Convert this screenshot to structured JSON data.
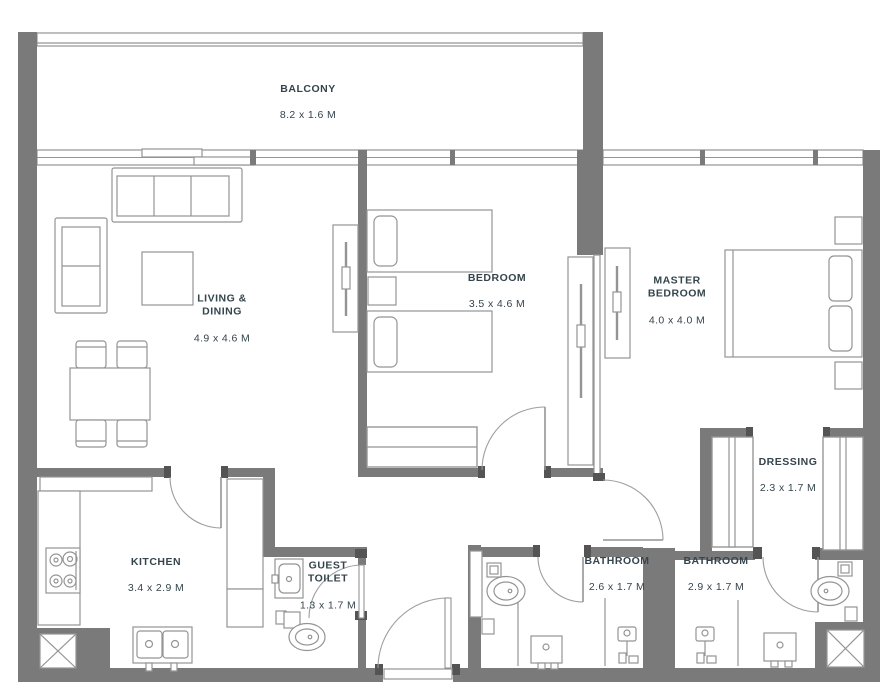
{
  "colors": {
    "wall": "#7a7a7a",
    "wall_dark": "#545454",
    "line": "#949494",
    "line_light": "#9e9e9e",
    "text": "#35454d",
    "bg": "#ffffff"
  },
  "rooms": {
    "balcony": {
      "name": "BALCONY",
      "dims": "8.2 x 1.6 M"
    },
    "living": {
      "name": "LIVING &\nDINING",
      "dims": "4.9 x 4.6 M"
    },
    "bedroom": {
      "name": "BEDROOM",
      "dims": "3.5 x 4.6 M"
    },
    "master": {
      "name": "MASTER\nBEDROOM",
      "dims": "4.0 x 4.0 M"
    },
    "kitchen": {
      "name": "KITCHEN",
      "dims": "3.4 x 2.9 M"
    },
    "guest_toilet": {
      "name": "GUEST\nTOILET",
      "dims": "1.3 x 1.7 M"
    },
    "bathroom_a": {
      "name": "BATHROOM",
      "dims": "2.6 x 1.7 M"
    },
    "bathroom_b": {
      "name": "BATHROOM",
      "dims": "2.9 x 1.7 M"
    },
    "dressing": {
      "name": "DRESSING",
      "dims": "2.3 x 1.7 M"
    }
  }
}
